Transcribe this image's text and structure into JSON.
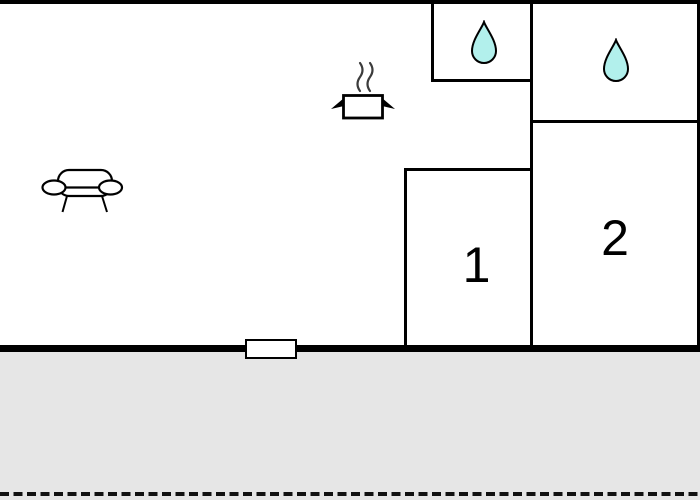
{
  "floorplan": {
    "rooms": [
      {
        "name": "room-1",
        "label": "1"
      },
      {
        "name": "room-2",
        "label": "2"
      }
    ],
    "icons": {
      "count_water_drops": 2,
      "names": [
        "water-drop-icon",
        "water-drop-icon",
        "cooking-pot-icon",
        "sofa-icon",
        "window-marker"
      ]
    },
    "colors": {
      "wall": "#000000",
      "water_drop_fill": "#b2f0ec",
      "terrace_fill": "#e6e6e6",
      "background": "#ffffff",
      "dash_boundary": "#111111",
      "steam": "#3c3c3c"
    }
  }
}
